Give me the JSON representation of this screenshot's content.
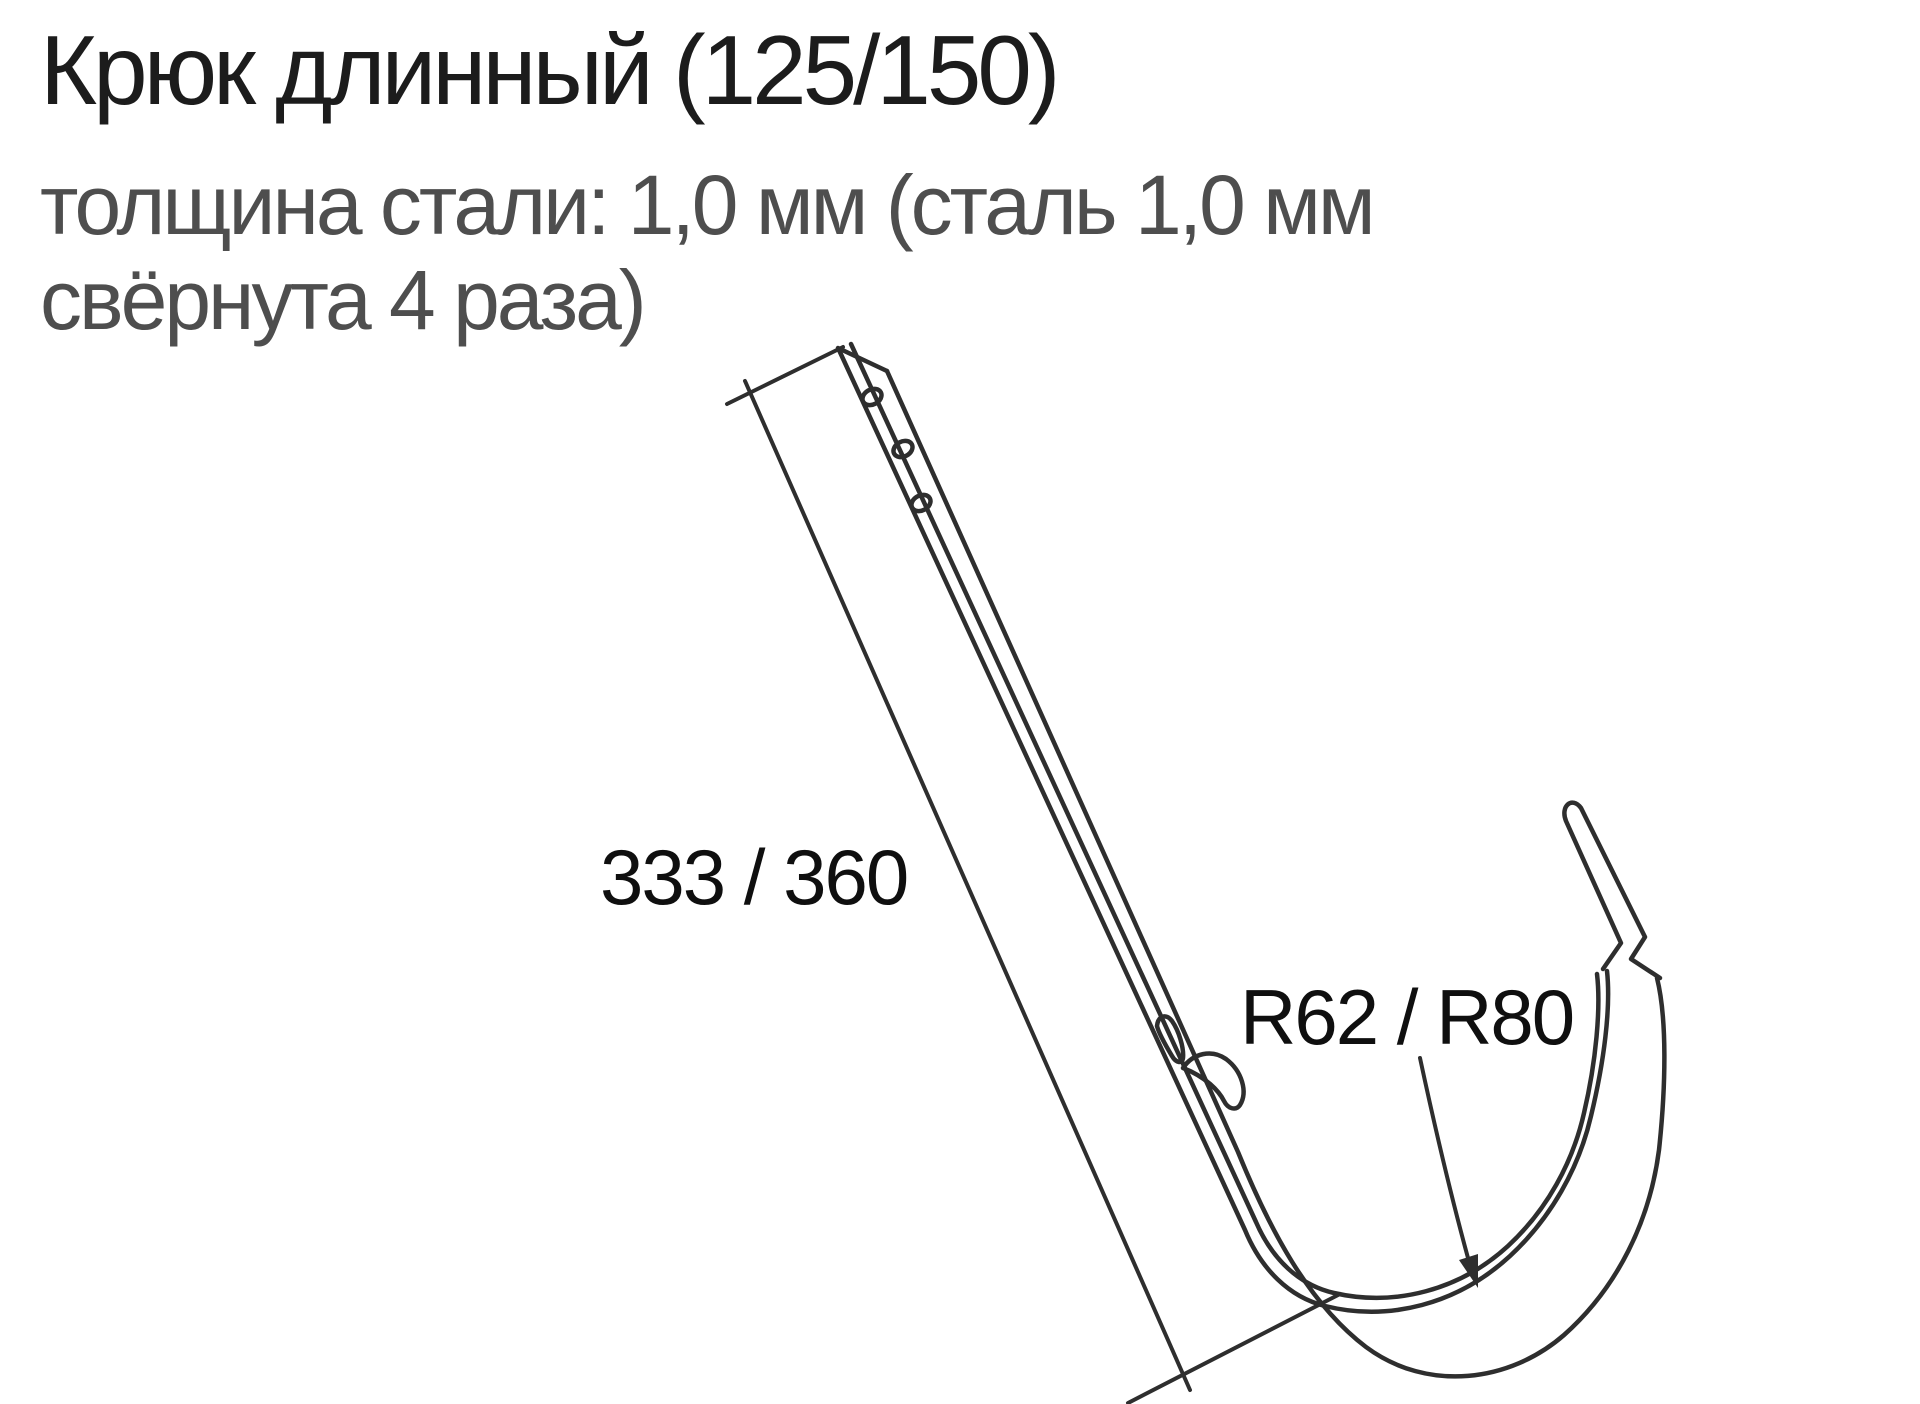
{
  "page": {
    "background_color": "#ffffff"
  },
  "header": {
    "title": "Крюк длинный (125/150)",
    "subtitle_line1": "толщина стали: 1,0 мм (сталь 1,0 мм",
    "subtitle_line2": "свёрнута 4 раза)"
  },
  "diagram": {
    "kind": "technical-line-drawing",
    "subject": "long gutter hook bracket",
    "labels": {
      "length_dimension": "333 / 360",
      "radius_dimension": "R62 / R80"
    },
    "colors": {
      "line": "#2e2e2e",
      "title_text": "#1c1c1c",
      "subtitle_text": "#4e4e4e",
      "label_text": "#0f0f0f"
    }
  }
}
